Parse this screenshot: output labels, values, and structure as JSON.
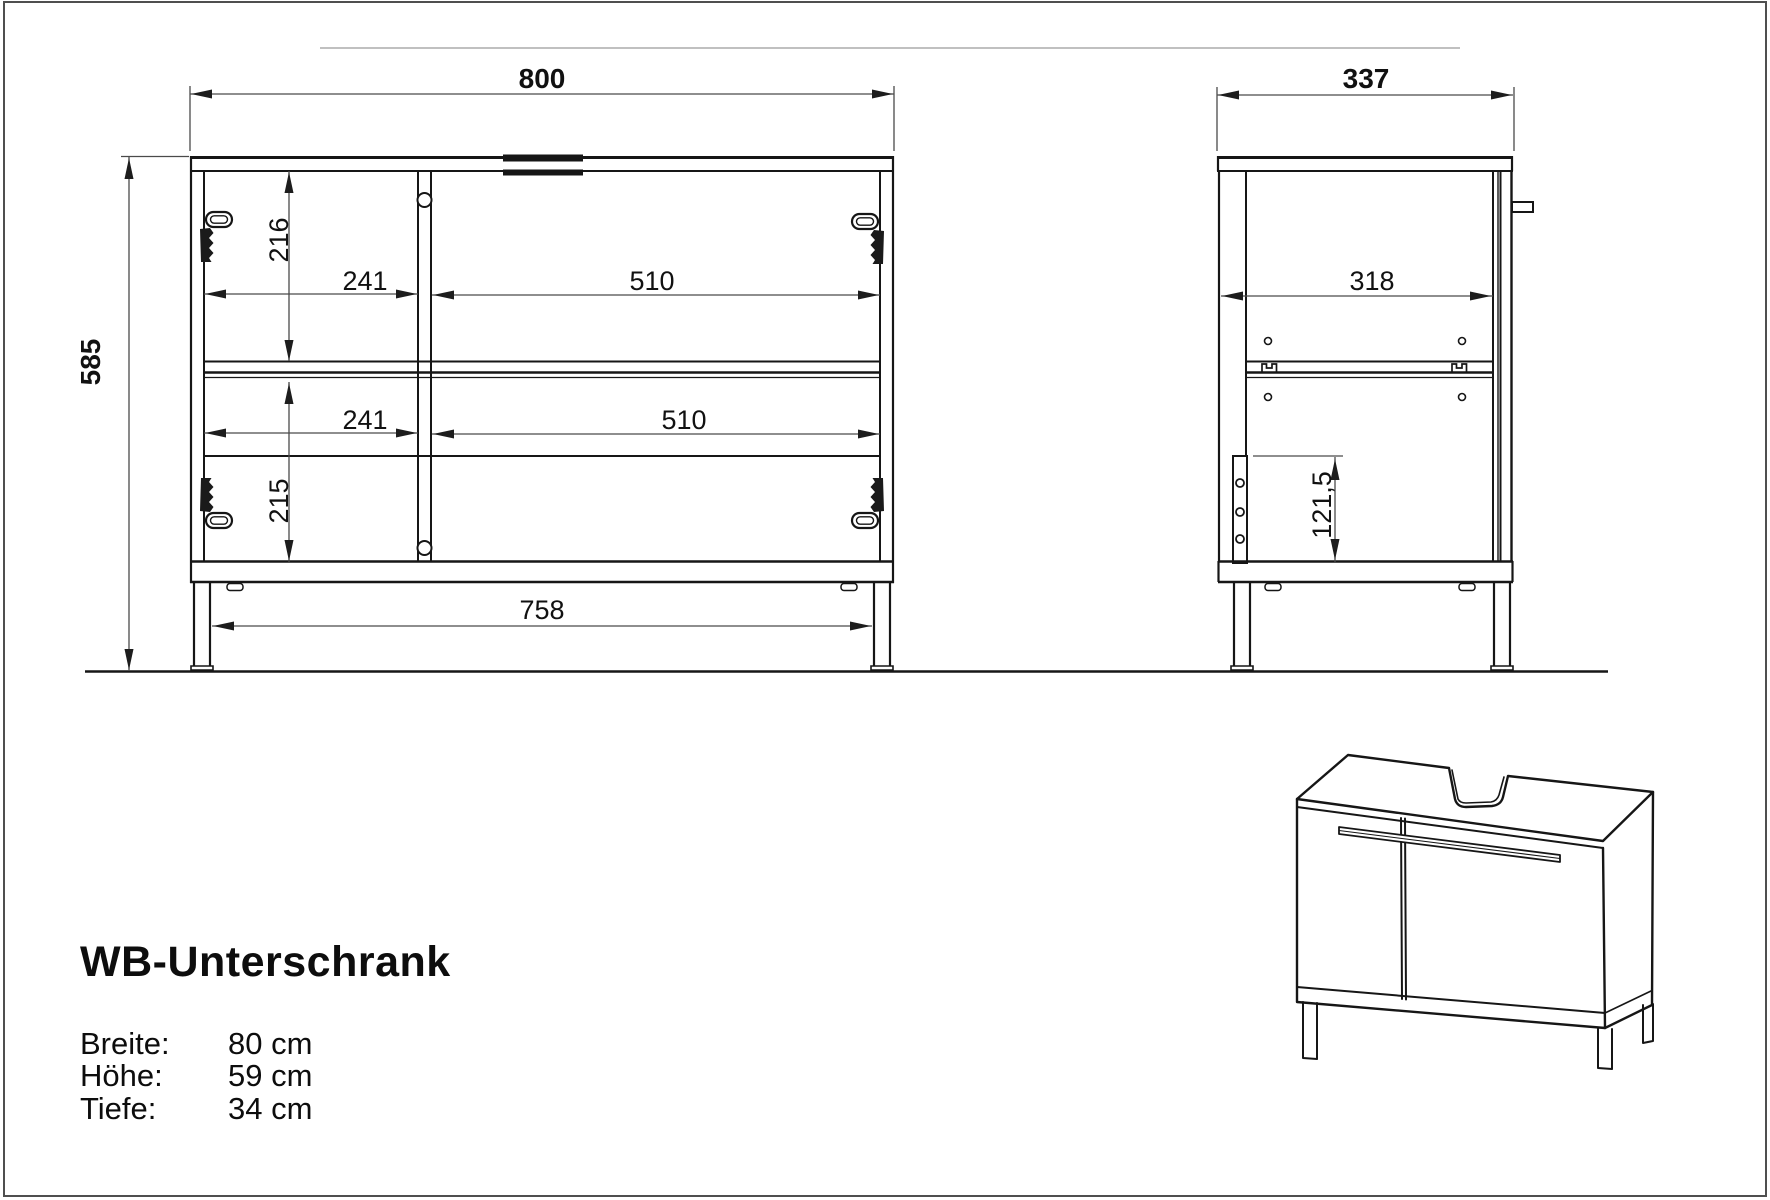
{
  "drawing_title": {
    "product_name": "WB-Unterschrank"
  },
  "specs": [
    {
      "label": "Breite:",
      "value": "80 cm"
    },
    {
      "label": "Höhe:",
      "value": "59 cm"
    },
    {
      "label": "Tiefe:",
      "value": "34 cm"
    }
  ],
  "front_view": {
    "width": "800",
    "height": "585",
    "upper_inner_height": "216",
    "lower_inner_height": "215",
    "upper_left_width": "241",
    "upper_right_width": "510",
    "lower_left_width": "241",
    "lower_right_width": "510",
    "leg_span": "758"
  },
  "side_view": {
    "depth": "337",
    "inner_depth": "318",
    "siphon_plate_height": "121,5"
  },
  "colors": {
    "object_line": "#161616",
    "dimension_line": "#4a4a4a",
    "text": "#111111",
    "background": "#ffffff"
  }
}
